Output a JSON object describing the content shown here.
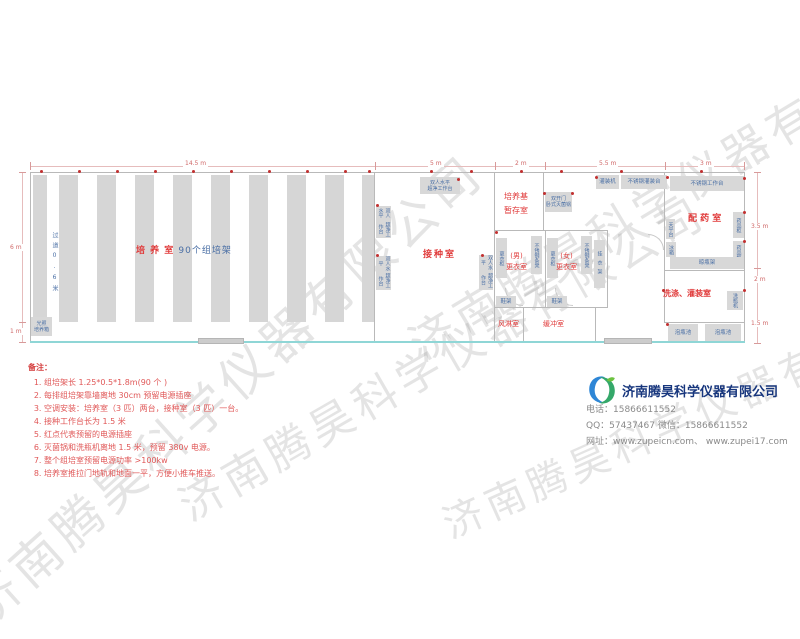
{
  "watermark": "济南腾昊科学仪器有限公司",
  "plan": {
    "dims": {
      "top": [
        "14.5 m",
        "5 m",
        "2 m",
        "5.5 m",
        "3 m"
      ],
      "left": [
        "6 m",
        "1 m"
      ],
      "right": [
        "3.5 m",
        "2 m",
        "1.5 m"
      ]
    },
    "culture": {
      "title_red": "培 养 室",
      "title_blue": "90个组培架",
      "aisle": "过道0.6米",
      "incubator_l1": "光照",
      "incubator_l2": "培养箱",
      "rack_count": 10
    },
    "inoculation": {
      "title": "接种室",
      "bench_l1": "双人水平",
      "bench_l2": "超净工作台"
    },
    "medium_storage": {
      "title": "培养基暂存室"
    },
    "sterilizer": {
      "l1": "双开门",
      "l2": "卧式灭菌锅"
    },
    "filling": {
      "machine": "灌装机",
      "table": "不锈钢灌装台",
      "worktable": "不锈钢工作台"
    },
    "mens": {
      "title1": "(男)",
      "title2": "更衣室",
      "locker": "更衣柜",
      "bench": "不锈钢条凳",
      "shoe_rack": "鞋架"
    },
    "womens": {
      "title1": "(女)",
      "title2": "更衣室",
      "locker": "更衣柜",
      "bench": "不锈钢条凳",
      "coat_rack": "挂衣架",
      "shoe_rack": "鞋架"
    },
    "air_shower": "风淋室",
    "buffer": "缓冲室",
    "pharmacy": {
      "title": "配 药 室",
      "cabinet": "药品柜",
      "balance": "天平台",
      "fridge": "冰箱",
      "dry_rack": "晾瓶架"
    },
    "washing": {
      "title": "洗涤、灌装室",
      "washer": "洗瓶机",
      "pool": "泡瓶池"
    }
  },
  "notes": {
    "title": "备注：",
    "items": [
      "组培架长 1.25*0.5*1.8m(90 个 )",
      "每排组培架靠墙离地 30cm 预留电源插座",
      "空调安装：培养室（3 匹）两台，接种室（3 匹）一台。",
      "接种工作台长为 1.5 米",
      "红点代表预留的电源插座",
      "灭菌锅和洗瓶机离地 1.5 米，预留 380v 电源。",
      "整个组培室预留电源功率 >100kw",
      "培养室推拉门地轨和地面一平，方便小推车推送。"
    ]
  },
  "company": {
    "name": "济南腾昊科学仪器有限公司",
    "phone_line": "电话：15866611552",
    "qq_line": "QQ：57437467   微信：15866611552",
    "web_line": "网址：www.zupeicn.com、 www.zupei17.com"
  },
  "colors": {
    "accent_red": "#e03a3a",
    "label_blue": "#4a6fa5",
    "wall_gray": "#b9b9b9",
    "glass_cyan": "#8fd6d6",
    "brand_blue": "#17367d"
  }
}
